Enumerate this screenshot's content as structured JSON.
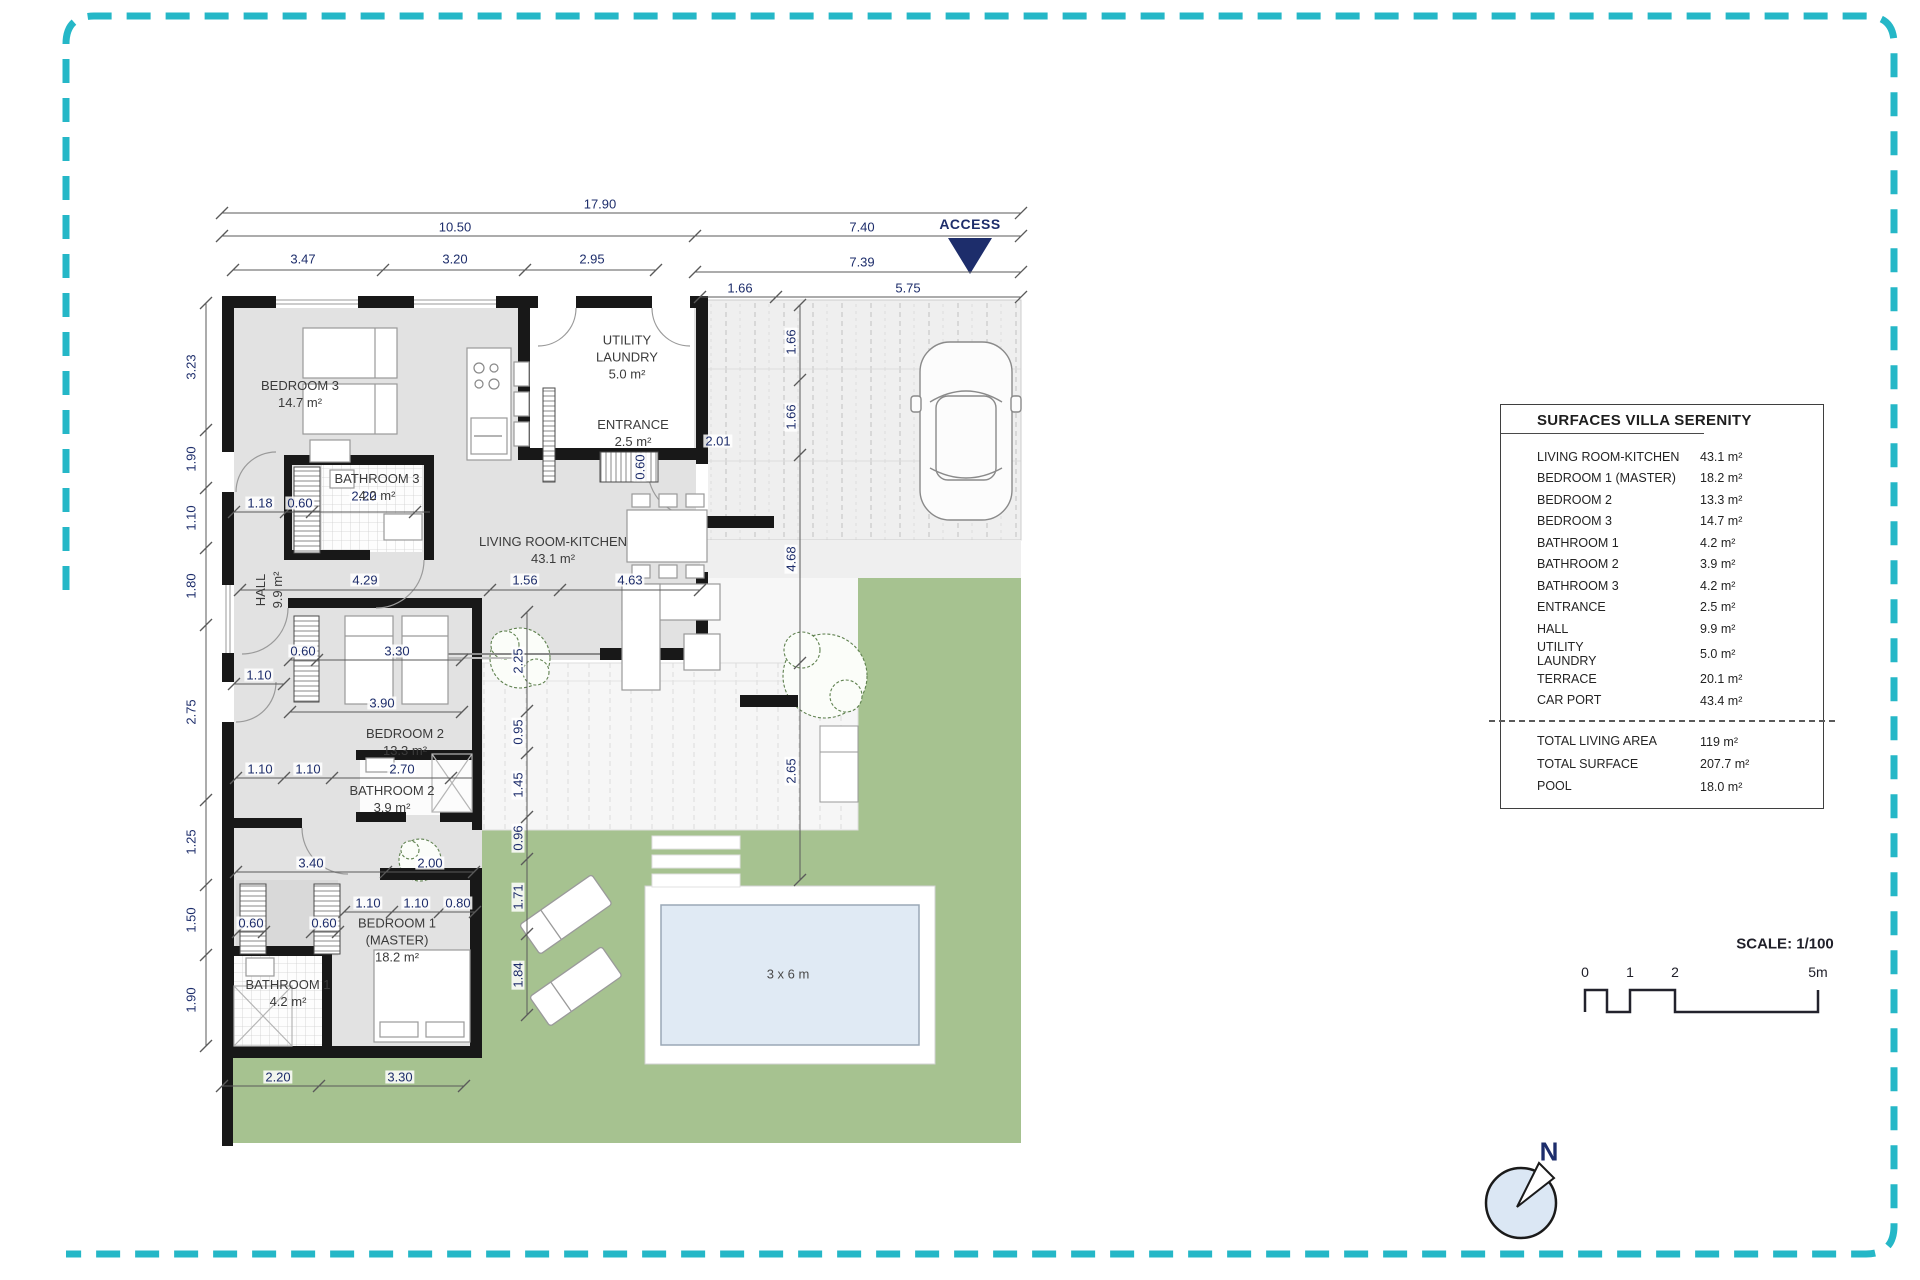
{
  "colors": {
    "border_teal": "#25b7c7",
    "dimension_navy": "#1d2d6b",
    "wall_black": "#181818",
    "floor_gray": "#e2e2e2",
    "garden_green": "#a6c290",
    "pool_water": "#e0eaf4"
  },
  "plan": {
    "access_label": "ACCESS",
    "rooms": {
      "bedroom3": {
        "name": "BEDROOM 3",
        "area": "14.7 m²"
      },
      "bathroom3": {
        "name": "BATHROOM 3",
        "area": "4.2 m²"
      },
      "utility": {
        "l1": "UTILITY",
        "l2": "LAUNDRY",
        "area": "5.0 m²"
      },
      "entrance": {
        "name": "ENTRANCE",
        "area": "2.5 m²"
      },
      "living": {
        "name": "LIVING ROOM-KITCHEN",
        "area": "43.1 m²"
      },
      "hall": {
        "name": "HALL",
        "area": "9.9 m²"
      },
      "bedroom2": {
        "name": "BEDROOM 2",
        "area": "13.3 m²"
      },
      "bathroom2": {
        "name": "BATHROOM 2",
        "area": "3.9 m²"
      },
      "bedroom1": {
        "l1": "BEDROOM 1",
        "l2": "(MASTER)",
        "area": "18.2 m²"
      },
      "bathroom1": {
        "name": "BATHROOM 1",
        "area": "4.2 m²"
      },
      "pool_label": "3 x 6 m"
    },
    "dim_labels": [
      {
        "t": "17.90",
        "x": 600,
        "y": 204
      },
      {
        "t": "10.50",
        "x": 455,
        "y": 227
      },
      {
        "t": "7.40",
        "x": 862,
        "y": 227
      },
      {
        "t": "3.47",
        "x": 303,
        "y": 259
      },
      {
        "t": "3.20",
        "x": 455,
        "y": 259
      },
      {
        "t": "2.95",
        "x": 592,
        "y": 259
      },
      {
        "t": "7.39",
        "x": 862,
        "y": 262
      },
      {
        "t": "1.66",
        "x": 740,
        "y": 288
      },
      {
        "t": "5.75",
        "x": 908,
        "y": 288
      },
      {
        "t": "3.23",
        "x": 191,
        "y": 367,
        "r": 1
      },
      {
        "t": "1.90",
        "x": 191,
        "y": 459,
        "r": 1
      },
      {
        "t": "1.10",
        "x": 191,
        "y": 518,
        "r": 1
      },
      {
        "t": "1.80",
        "x": 191,
        "y": 586,
        "r": 1
      },
      {
        "t": "2.75",
        "x": 191,
        "y": 712,
        "r": 1
      },
      {
        "t": "1.25",
        "x": 191,
        "y": 842,
        "r": 1
      },
      {
        "t": "1.50",
        "x": 191,
        "y": 920,
        "r": 1
      },
      {
        "t": "1.90",
        "x": 191,
        "y": 1000,
        "r": 1
      },
      {
        "t": "1.66",
        "x": 791,
        "y": 342,
        "r": 1
      },
      {
        "t": "1.66",
        "x": 791,
        "y": 417,
        "r": 1
      },
      {
        "t": "4.68",
        "x": 791,
        "y": 559,
        "r": 1
      },
      {
        "t": "2.65",
        "x": 791,
        "y": 771,
        "r": 1
      },
      {
        "t": "2.25",
        "x": 518,
        "y": 661,
        "r": 1
      },
      {
        "t": "0.95",
        "x": 518,
        "y": 732,
        "r": 1
      },
      {
        "t": "1.45",
        "x": 518,
        "y": 785,
        "r": 1
      },
      {
        "t": "0.96",
        "x": 518,
        "y": 838,
        "r": 1
      },
      {
        "t": "1.71",
        "x": 518,
        "y": 897,
        "r": 1
      },
      {
        "t": "1.84",
        "x": 518,
        "y": 975,
        "r": 1
      },
      {
        "t": "1.18",
        "x": 260,
        "y": 503
      },
      {
        "t": "0.60",
        "x": 300,
        "y": 503
      },
      {
        "t": "2.20",
        "x": 364,
        "y": 496
      },
      {
        "t": "2.01",
        "x": 718,
        "y": 441
      },
      {
        "t": "0.60",
        "x": 640,
        "y": 467,
        "r": 1
      },
      {
        "t": "4.29",
        "x": 365,
        "y": 580
      },
      {
        "t": "1.56",
        "x": 525,
        "y": 580
      },
      {
        "t": "4.63",
        "x": 630,
        "y": 580
      },
      {
        "t": "0.60",
        "x": 303,
        "y": 651
      },
      {
        "t": "3.30",
        "x": 397,
        "y": 651
      },
      {
        "t": "1.10",
        "x": 259,
        "y": 675
      },
      {
        "t": "3.90",
        "x": 382,
        "y": 703
      },
      {
        "t": "1.10",
        "x": 260,
        "y": 769
      },
      {
        "t": "1.10",
        "x": 308,
        "y": 769
      },
      {
        "t": "2.70",
        "x": 402,
        "y": 769
      },
      {
        "t": "3.40",
        "x": 311,
        "y": 863
      },
      {
        "t": "2.00",
        "x": 430,
        "y": 863
      },
      {
        "t": "1.10",
        "x": 368,
        "y": 903
      },
      {
        "t": "1.10",
        "x": 416,
        "y": 903
      },
      {
        "t": "0.80",
        "x": 458,
        "y": 903
      },
      {
        "t": "0.60",
        "x": 251,
        "y": 923
      },
      {
        "t": "0.60",
        "x": 324,
        "y": 923
      },
      {
        "t": "2.20",
        "x": 278,
        "y": 1077
      },
      {
        "t": "3.30",
        "x": 400,
        "y": 1077
      }
    ]
  },
  "surfaces": {
    "title": "SURFACES VILLA SERENITY",
    "rows": [
      {
        "label": "LIVING ROOM-KITCHEN",
        "value": "43.1 m²"
      },
      {
        "label": "BEDROOM 1 (MASTER)",
        "value": "18.2 m²"
      },
      {
        "label": "BEDROOM 2",
        "value": "13.3 m²"
      },
      {
        "label": "BEDROOM 3",
        "value": "14.7 m²"
      },
      {
        "label": "BATHROOM 1",
        "value": "4.2 m²"
      },
      {
        "label": "BATHROOM 2",
        "value": "3.9 m²"
      },
      {
        "label": "BATHROOM 3",
        "value": "4.2 m²"
      },
      {
        "label": "ENTRANCE",
        "value": "2.5 m²"
      },
      {
        "label": "HALL",
        "value": "9.9 m²"
      },
      {
        "label": "UTILITY\nLAUNDRY",
        "value": "5.0 m²"
      },
      {
        "label": "TERRACE",
        "value": "20.1 m²"
      },
      {
        "label": "CAR PORT",
        "value": "43.4 m²"
      }
    ],
    "totals": [
      {
        "label": "TOTAL LIVING AREA",
        "value": "119 m²"
      },
      {
        "label": "TOTAL SURFACE",
        "value": "207.7 m²"
      },
      {
        "label": "POOL",
        "value": "18.0 m²"
      }
    ]
  },
  "scale": {
    "title": "SCALE: 1/100",
    "ticks": [
      "0",
      "1",
      "2",
      "5m"
    ]
  },
  "compass": {
    "north": "N"
  }
}
